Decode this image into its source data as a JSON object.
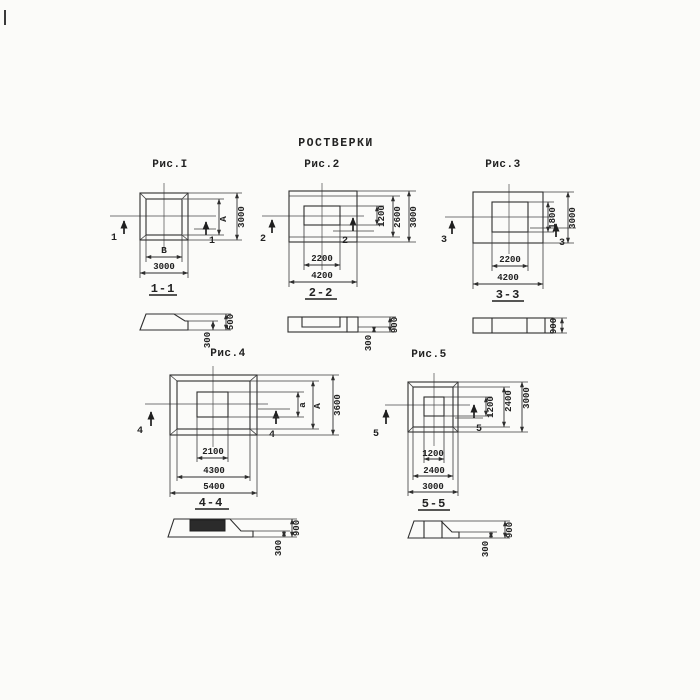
{
  "title": "РОСТВЕРКИ",
  "fig1": {
    "label": "Рис.I",
    "marker": "1",
    "section_label": "1-1",
    "dim_inner_h": "А",
    "dim_outer_h": "3000",
    "dim_inner_w": "В",
    "dim_outer_w": "3000"
  },
  "fig2": {
    "label": "Рис.2",
    "marker": "2",
    "section_label": "2-2",
    "dim_inner_h": "1200",
    "dim_mid_h": "2600",
    "dim_outer_h": "3000",
    "dim_inner_w": "2200",
    "dim_outer_w": "4200"
  },
  "fig3": {
    "label": "Рис.3",
    "marker": "3",
    "section_label": "3-3",
    "dim_inner_h": "1800",
    "dim_outer_h": "3000",
    "dim_inner_w": "2200",
    "dim_outer_w": "4200"
  },
  "fig4": {
    "label": "Рис.4",
    "marker": "4",
    "section_label": "4-4",
    "dim_inner_h": "а",
    "dim_mid_h": "А",
    "dim_outer_h": "3600",
    "dim_inner_w": "2100",
    "dim_mid_w": "4300",
    "dim_outer_w": "5400"
  },
  "fig5": {
    "label": "Рис.5",
    "marker": "5",
    "section_label": "5-5",
    "dim_inner_h": "1200",
    "dim_mid_h": "2400",
    "dim_outer_h": "3000",
    "dim_inner_w": "1200",
    "dim_mid_w": "2400",
    "dim_outer_w": "3000"
  },
  "sec1": {
    "h_ledge": "300",
    "h_total": "500"
  },
  "sec2": {
    "h_ledge": "300",
    "h_total": "900"
  },
  "sec3": {
    "h_total": "900"
  },
  "sec4": {
    "h_ledge": "300",
    "h_total": "900"
  },
  "sec5": {
    "h_ledge": "300",
    "h_total": "900"
  },
  "colors": {
    "ink": "#2e2e2e",
    "paper": "#fbfbf9"
  }
}
